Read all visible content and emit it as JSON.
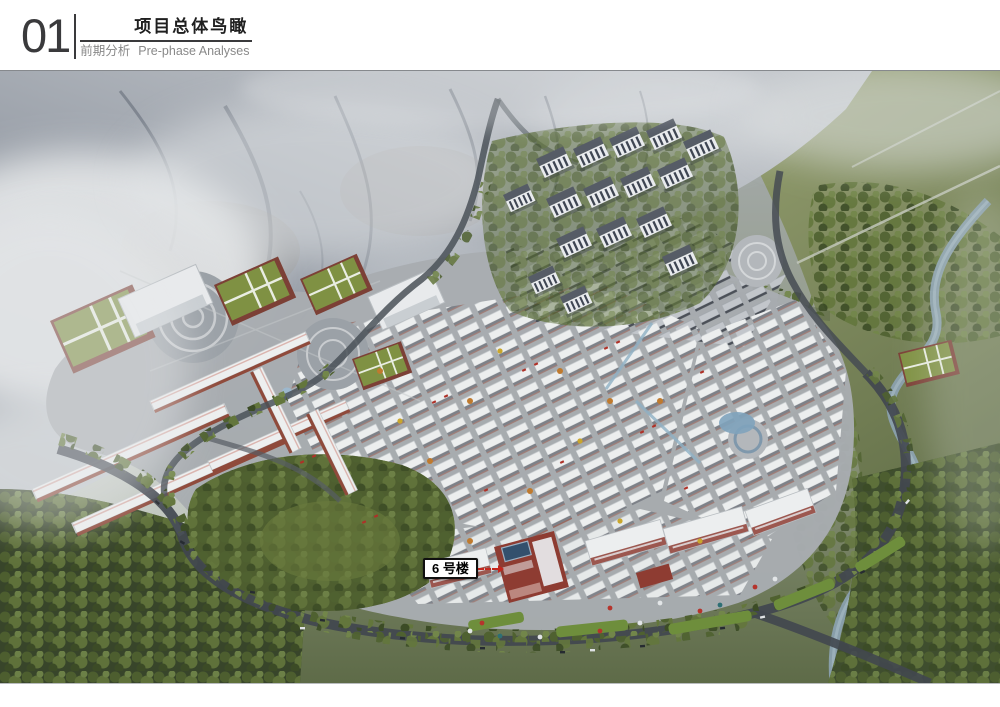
{
  "header": {
    "section_number": "01",
    "title": "项目总体鸟瞰",
    "subtitle_zh": "前期分析",
    "subtitle_en": "Pre-phase Analyses"
  },
  "rendering": {
    "annotation": {
      "label": "6 号楼",
      "arrow_color": "#c4261d"
    },
    "palette": {
      "mountain_gray": "#8d939c",
      "haze_white": "#e7e9eb",
      "field_green": "#6e7b4e",
      "forest_green": "#42512c",
      "town_ground_gray": "#a8acb1",
      "roof_white": "#ebedee",
      "wall_red": "#8e3c32",
      "road_dark": "#454b52",
      "water_blue": "#8aa6ba"
    }
  }
}
